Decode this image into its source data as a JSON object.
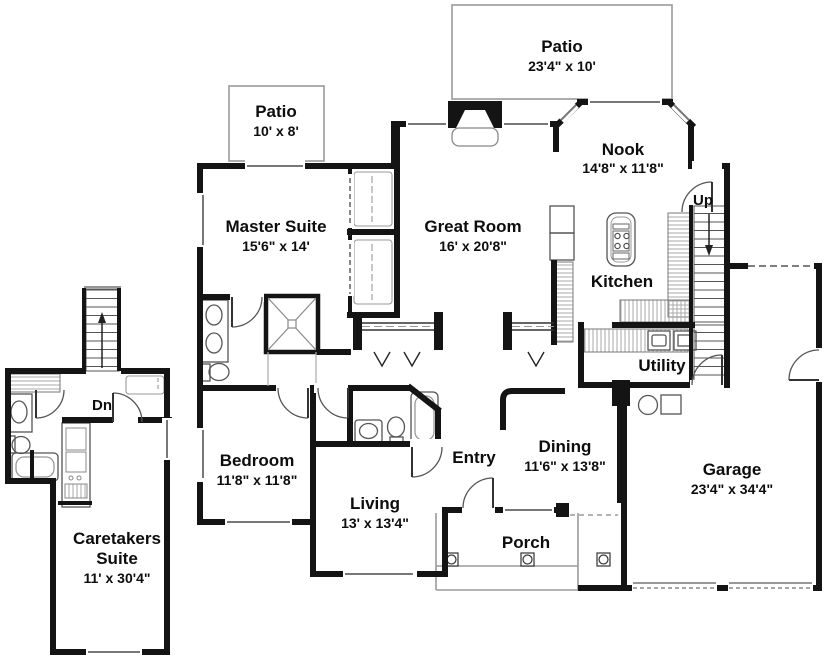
{
  "colors": {
    "wall": "#141414",
    "thin_outline": "#9a9a9a",
    "fixture": "#555555",
    "window": "#777777",
    "text": "#0d0d0d",
    "background": "#ffffff"
  },
  "rooms": {
    "patio_main": {
      "name": "Patio",
      "dims": "23'4\" x 10'"
    },
    "patio_master": {
      "name": "Patio",
      "dims": "10' x 8'"
    },
    "nook": {
      "name": "Nook",
      "dims": "14'8\" x 11'8\""
    },
    "master_suite": {
      "name": "Master Suite",
      "dims": "15'6\" x 14'"
    },
    "great_room": {
      "name": "Great Room",
      "dims": "16' x 20'8\""
    },
    "kitchen": {
      "name": "Kitchen"
    },
    "utility": {
      "name": "Utility"
    },
    "bedroom": {
      "name": "Bedroom",
      "dims": "11'8\" x 11'8\""
    },
    "entry": {
      "name": "Entry"
    },
    "dining": {
      "name": "Dining",
      "dims": "11'6\" x 13'8\""
    },
    "living": {
      "name": "Living",
      "dims": "13' x 13'4\""
    },
    "porch": {
      "name": "Porch"
    },
    "garage": {
      "name": "Garage",
      "dims": "23'4\" x 34'4\""
    },
    "caretakers_suite": {
      "name_line1": "Caretakers",
      "name_line2": "Suite",
      "dims": "11' x 30'4\""
    }
  },
  "stairs": {
    "up_label": "Up",
    "down_label": "Dn"
  }
}
